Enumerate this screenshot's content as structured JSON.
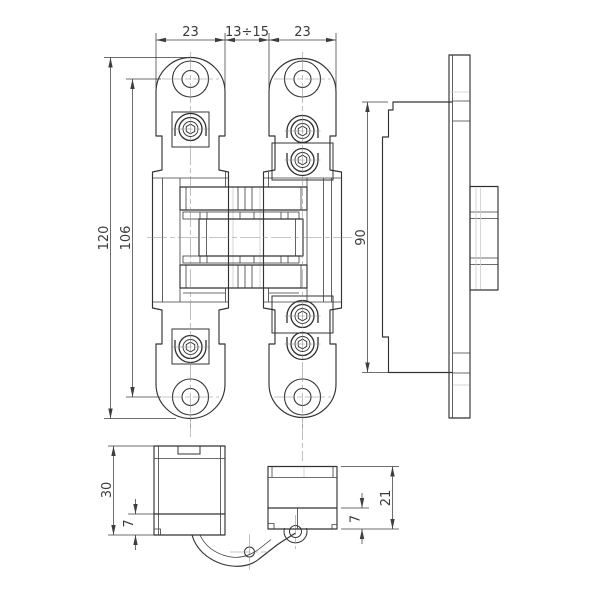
{
  "drawing": {
    "background": "#ffffff",
    "line_color": "#333333",
    "dim_color": "#3d3d3d",
    "views": {
      "front": {
        "dim_plate_width_left": "23",
        "dim_door_gap": "13÷15",
        "dim_plate_width_right": "23",
        "dim_total_height": "120",
        "dim_hole_spacing": "106"
      },
      "side": {
        "dim_body_height": "90"
      },
      "open_left": {
        "dim_body_depth": "30",
        "dim_lip_height": "7"
      },
      "open_right": {
        "dim_lip_height": "7",
        "dim_body_depth": "21"
      }
    }
  }
}
